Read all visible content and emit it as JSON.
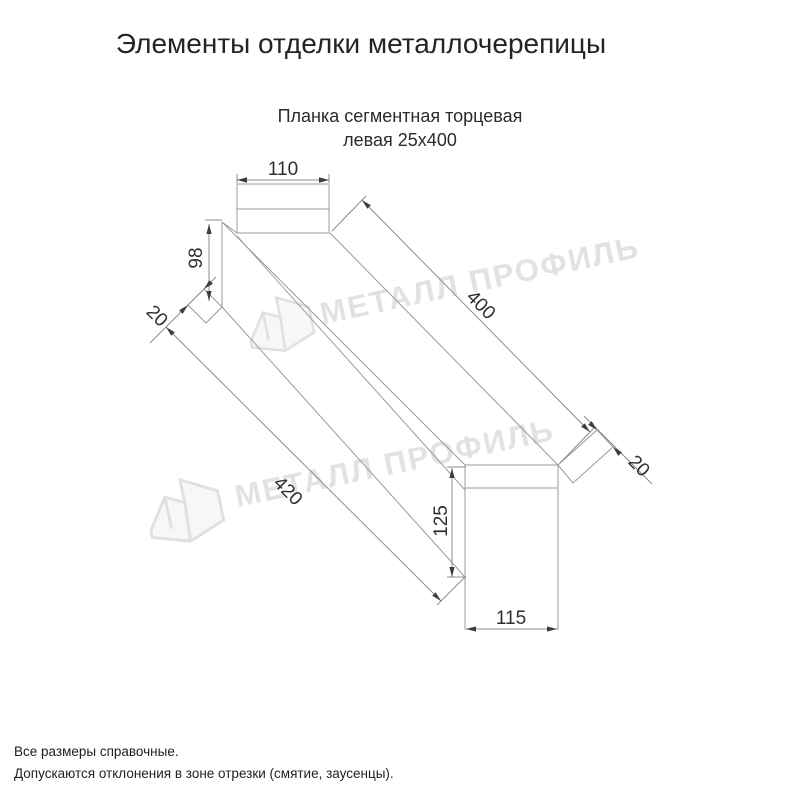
{
  "title": "Элементы отделки металлочерепицы",
  "subtitle": {
    "line1": "Планка сегментная торцевая",
    "line2": "левая 25х400"
  },
  "drawing": {
    "dim_top_tab_width": "110",
    "dim_end_fold_height": "98",
    "dim_left_hem": "20",
    "dim_length": "400",
    "dim_right_hem": "20",
    "dim_bottom_length": "420",
    "dim_end_height": "125",
    "dim_end_width": "115"
  },
  "watermark": {
    "text": "МЕТАЛЛ ПРОФИЛЬ"
  },
  "notes": {
    "line1": "Все размеры справочные.",
    "line2": "Допускаются отклонения в зоне отрезки (смятие, заусенцы)."
  },
  "colors": {
    "line": "#9b9b9b",
    "dim_line": "#8c8c8c",
    "dim_text": "#2e2e2e",
    "watermark": "#e2e2e2",
    "title_text": "#242424"
  }
}
